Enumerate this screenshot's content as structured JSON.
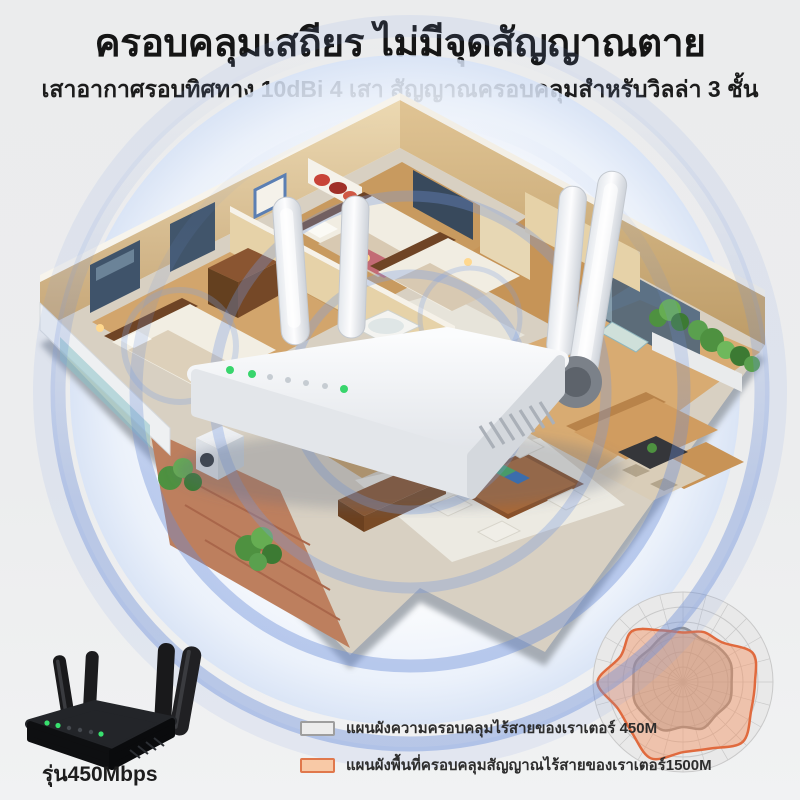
{
  "header": {
    "title": "ครอบคลุมเสถียร ไม่มีจุดสัญญาณตาย",
    "subtitle": "เสาอากาศรอบทิศทาง 10dBi  4 เสา สัญญาณครอบคลุมสำหรับวิลล่า 3 ชั้น"
  },
  "product": {
    "model_label": "รุ่น450Mbps"
  },
  "legend": [
    {
      "label": "แผนผังความครอบคลุมไร้สายของเราเตอร์ 450M",
      "border": "#9e9e9e",
      "fill": "#ececec"
    },
    {
      "label": "แผนผังพื้นที่ครอบคลุมสัญญาณไร้สายของเราเตอร์1500M",
      "border": "#e0784c",
      "fill": "#f8c9a6"
    }
  ],
  "colors": {
    "signal_blue": "#6e8fd8",
    "router_led_green": "#38d56c",
    "radar_gray": "#8f8f8f",
    "radar_orange": "#e06a3e"
  },
  "chart_data": {
    "type": "radar",
    "title": "",
    "rings": 6,
    "spokes": 24,
    "grid_color": "#c9c9c9",
    "bg_color": "#e9e9e9",
    "series": [
      {
        "name": "450M",
        "stroke": "#8f8f8f",
        "fill": "rgba(140,140,140,0.38)",
        "radii": [
          0.6,
          0.52,
          0.55,
          0.57,
          0.54,
          0.56,
          0.52,
          0.56,
          0.5,
          0.58,
          0.56,
          0.58,
          0.55,
          0.57,
          0.52,
          0.56
        ]
      },
      {
        "name": "1500M",
        "stroke": "#e06a3e",
        "fill": "rgba(243,146,98,0.45)",
        "radii": [
          0.55,
          0.6,
          0.62,
          0.84,
          0.8,
          0.82,
          0.94,
          0.8,
          0.78,
          0.92,
          0.8,
          0.78,
          0.95,
          0.75,
          0.8,
          0.62
        ]
      }
    ]
  }
}
